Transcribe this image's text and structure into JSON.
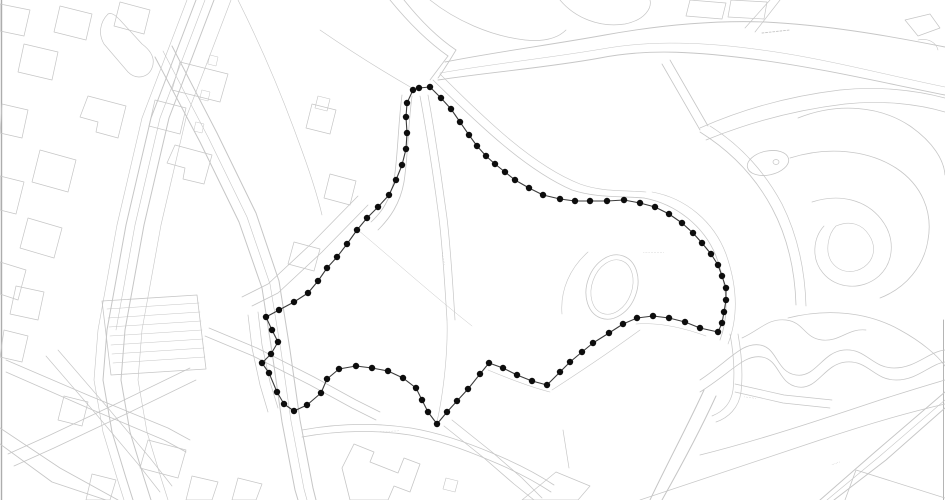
{
  "document": {
    "type": "site-location-plan",
    "canvas": {
      "width": 945,
      "height": 500
    }
  },
  "colors": {
    "background": "#ffffff",
    "map_line": "#c6c6c6",
    "map_line_dark": "#adadad",
    "sheet_edge": "#6f6f6f",
    "boundary_line": "#3c3c3c",
    "boundary_dot": "#0d0d0d",
    "micro_label": "#9a9a9a"
  },
  "boundary": {
    "name": "site-boundary",
    "closed": true,
    "line_width": 1.1,
    "dot_radius": 3.2,
    "points": [
      [
        413,
        90
      ],
      [
        419,
        88
      ],
      [
        430,
        87
      ],
      [
        441,
        98
      ],
      [
        451,
        109
      ],
      [
        460,
        122
      ],
      [
        469,
        135
      ],
      [
        477,
        146
      ],
      [
        486,
        156
      ],
      [
        495,
        164
      ],
      [
        505,
        172
      ],
      [
        515,
        180
      ],
      [
        529,
        188
      ],
      [
        543,
        195
      ],
      [
        560,
        199
      ],
      [
        575,
        201
      ],
      [
        590,
        201
      ],
      [
        607,
        201
      ],
      [
        624,
        200
      ],
      [
        640,
        203
      ],
      [
        655,
        207
      ],
      [
        669,
        214
      ],
      [
        682,
        223
      ],
      [
        693,
        233
      ],
      [
        702,
        243
      ],
      [
        711,
        254
      ],
      [
        718,
        265
      ],
      [
        722,
        276
      ],
      [
        726,
        288
      ],
      [
        726,
        300
      ],
      [
        724,
        312
      ],
      [
        722,
        323
      ],
      [
        718,
        332
      ],
      [
        700,
        328
      ],
      [
        685,
        322
      ],
      [
        669,
        318
      ],
      [
        653,
        316
      ],
      [
        637,
        318
      ],
      [
        623,
        324
      ],
      [
        609,
        333
      ],
      [
        593,
        343
      ],
      [
        582,
        352
      ],
      [
        570,
        362
      ],
      [
        560,
        372
      ],
      [
        547,
        385
      ],
      [
        532,
        381
      ],
      [
        517,
        375
      ],
      [
        503,
        368
      ],
      [
        489,
        363
      ],
      [
        480,
        374
      ],
      [
        468,
        389
      ],
      [
        457,
        401
      ],
      [
        447,
        412
      ],
      [
        437,
        424
      ],
      [
        428,
        412
      ],
      [
        422,
        400
      ],
      [
        416,
        388
      ],
      [
        403,
        378
      ],
      [
        388,
        371
      ],
      [
        372,
        368
      ],
      [
        356,
        366
      ],
      [
        339,
        369
      ],
      [
        327,
        379
      ],
      [
        321,
        393
      ],
      [
        307,
        405
      ],
      [
        294,
        411
      ],
      [
        284,
        404
      ],
      [
        277,
        392
      ],
      [
        269,
        373
      ],
      [
        262,
        363
      ],
      [
        271,
        354
      ],
      [
        278,
        342
      ],
      [
        272,
        330
      ],
      [
        266,
        317
      ],
      [
        279,
        310
      ],
      [
        294,
        302
      ],
      [
        308,
        293
      ],
      [
        318,
        281
      ],
      [
        327,
        268
      ],
      [
        337,
        257
      ],
      [
        347,
        244
      ],
      [
        357,
        230
      ],
      [
        367,
        218
      ],
      [
        378,
        207
      ],
      [
        389,
        195
      ],
      [
        396,
        180
      ],
      [
        402,
        165
      ],
      [
        406,
        149
      ],
      [
        407,
        133
      ],
      [
        406,
        117
      ],
      [
        407,
        103
      ]
    ]
  },
  "map": {
    "paths": [
      {
        "d": "M1.5,0 L1.5,500",
        "w": 1.4,
        "c": "dark"
      },
      {
        "d": "M943.5,320 L943.5,500",
        "w": 0.9,
        "c": "dark"
      },
      {
        "d": "M196,0 L151,118 126,225 107,330 103,380 112,432 126,478 133,500",
        "w": 1
      },
      {
        "d": "M214,0 L169,118 144,225 125,330 121,380 130,432 144,478 151,500",
        "w": 1
      },
      {
        "d": "M205,0 L160,118 135,225 116,330",
        "w": 0.6
      },
      {
        "d": "M187,0 L142,118 117,225 98,330 94,380 103,432 117,478 124,500",
        "w": 0.6
      },
      {
        "d": "M231,0 L186,118 161,225 142,330 138,380 147,432 161,478 168,500",
        "w": 0.6
      },
      {
        "d": "M210,55 L218,57 216,66 208,64 Z",
        "w": 0.5
      },
      {
        "d": "M202,90 L210,92 208,101 200,99 Z",
        "w": 0.5
      },
      {
        "d": "M196,122 L204,124 202,133 194,131 Z",
        "w": 0.5
      },
      {
        "d": "M108,14 C100,22 98,34 104,44 L128,72 C136,80 148,78 152,68 C156,58 150,50 142,44 L120,20 C116,16 112,12 108,14 Z",
        "w": 0.7
      },
      {
        "d": "M172,46 L217,133 256,213 279,281 290,350 300,420 313,488 316,500",
        "w": 1
      },
      {
        "d": "M155,57 L200,142 239,222 262,288 272,352 282,422 295,490 298,500",
        "w": 1
      },
      {
        "d": "M163,51 L208,137 247,217 270,284 281,351 291,421 304,489 307,500",
        "w": 0.6
      },
      {
        "d": "M258,312 L262,345 270,382 278,408",
        "w": 0.7
      },
      {
        "d": "M248,315 L252,348 260,385 268,412",
        "w": 0.7
      },
      {
        "d": "M205,336 L253,356 310,385 352,408 376,420",
        "w": 0.8
      },
      {
        "d": "M209,328 L257,348 314,377 356,400 380,412",
        "w": 0.8
      },
      {
        "d": "M302,437 C340,430 378,430 410,435 C438,440 463,449 489,460 C511,469 533,480 551,492",
        "w": 0.8
      },
      {
        "d": "M302,430 C340,423 378,423 411,428 C440,433 466,442 492,453 C514,462 536,473 554,485",
        "w": 0.8
      },
      {
        "d": "M342,468 L354,444 374,452 370,462 398,473 404,458 420,464 410,492 394,486 388,500 350,500 Z",
        "w": 0.8
      },
      {
        "d": "M446,478 L458,481 455,492 443,489 Z",
        "w": 0.6
      },
      {
        "d": "M452,420 L492,452 522,478 542,498",
        "w": 0.8
      },
      {
        "d": "M444,426 L484,458 514,484 534,500",
        "w": 0.8
      },
      {
        "d": "M563,430 L569,468",
        "w": 0.7
      },
      {
        "d": "M522,500 L556,472 590,486 578,500 Z",
        "w": 0.7
      },
      {
        "d": "M704,390 C688,425 668,462 650,500",
        "w": 1
      },
      {
        "d": "M716,396 C700,431 680,468 662,500",
        "w": 1
      },
      {
        "d": "M730,334 C734,355 735,372 733,390 C731,404 722,412 712,416",
        "w": 0.7
      },
      {
        "d": "M738,334 C742,356 743,374 741,392 C739,408 728,418 716,422",
        "w": 0.7
      },
      {
        "d": "M735,392 L783,403 830,408",
        "w": 0.7
      },
      {
        "d": "M735,384 L784,395 832,400",
        "w": 0.7
      },
      {
        "d": "M700,380 C730,360 742,342 760,345 C778,348 776,372 796,375 C816,378 822,352 844,350 C866,348 872,368 894,368 C916,368 928,352 945,350",
        "w": 0.8
      },
      {
        "d": "M700,392 C732,372 744,354 762,357 C780,360 778,384 798,387 C818,390 824,364 846,362 C868,360 874,380 896,380 C918,380 930,364 945,362",
        "w": 0.8
      },
      {
        "d": "M742,338 C760,330 768,318 786,320 C804,322 804,338 822,340 C840,342 848,328 866,330",
        "w": 0.7
      },
      {
        "d": "M700,455 C760,440 820,420 880,400 C905,392 928,385 945,380",
        "w": 0.8
      },
      {
        "d": "M640,500 C700,480 760,460 820,440 C865,425 910,412 945,404",
        "w": 0.7
      },
      {
        "d": "M945,392 L875,452 820,500",
        "w": 1
      },
      {
        "d": "M945,408 L886,460 834,500",
        "w": 1
      },
      {
        "d": "M945,400 L880,456 827,500",
        "w": 0.6
      },
      {
        "d": "M845,500 L856,470 945,498",
        "w": 0.8
      },
      {
        "d": "M798,118 C838,102 880,106 910,126 C933,142 944,160 945,175",
        "w": 0.8
      },
      {
        "d": "M790,158 C828,146 868,150 896,168 C922,185 933,212 928,240 C924,266 906,288 880,298",
        "w": 0.8
      },
      {
        "d": "M812,202 C840,193 866,200 881,219 C896,238 894,262 879,276 C862,291 836,289 823,273 C811,259 813,238 824,226",
        "w": 0.7
      },
      {
        "d": "M836,226 C850,220 862,224 869,235 C877,247 874,260 864,267 C852,275 838,272 831,261 C825,251 828,234 836,226",
        "w": 0.6
      },
      {
        "d": "M788,318 C828,308 868,312 900,330 C922,342 938,356 945,366",
        "w": 0.8
      },
      {
        "d": "M700,132 C732,152 756,178 772,208 C788,238 795,272 796,305",
        "w": 0.8
      },
      {
        "d": "M710,126 C742,146 766,174 782,204 C798,236 805,272 806,306",
        "w": 0.7
      },
      {
        "d": "M905,20 L930,14 940,28 918,36 Z",
        "w": 0.7
      },
      {
        "d": "M918,40 C928,38 936,42 938,50",
        "w": 0.6
      },
      {
        "d": "M438,80 C490,72 545,68 600,58 C650,48 700,52 760,60 C820,68 880,82 945,95",
        "w": 0.9
      },
      {
        "d": "M445,62 C495,52 550,45 605,35 C655,26 710,20 765,22 C825,25 885,35 945,47",
        "w": 0.9
      },
      {
        "d": "M440,73 C492,64 548,58 602,49 C652,40 705,42 762,50 C822,58 882,74 945,87",
        "w": 0.5
      },
      {
        "d": "M662,64 L700,130",
        "w": 0.8
      },
      {
        "d": "M670,60 L708,126",
        "w": 0.8
      },
      {
        "d": "M762,33 L790,30",
        "w": 0.9,
        "dash": "2,1.6"
      },
      {
        "d": "M700,128 C745,108 790,96 840,90 C878,86 915,90 945,98",
        "w": 0.7
      },
      {
        "d": "M706,140 C750,122 795,110 845,104 C882,100 918,104 945,112",
        "w": 0.7
      },
      {
        "d": "M690,0 L686,16 722,19 726,3 Z",
        "w": 0.7
      },
      {
        "d": "M731,0 L728,17 764,19 767,2 Z",
        "w": 0.7
      },
      {
        "d": "M770,0 L745,28",
        "w": 0.7
      },
      {
        "d": "M780,0 L755,32",
        "w": 0.7
      },
      {
        "d": "M560,0 C575,18 600,28 625,24 C645,20 652,8 650,0",
        "w": 0.7
      },
      {
        "d": "M430,0 C455,20 490,36 525,40 C545,42 558,38 566,30",
        "w": 0.7
      },
      {
        "d": "M390,0 C408,22 428,42 448,56",
        "w": 0.8
      },
      {
        "d": "M404,0 C420,20 438,38 456,50",
        "w": 0.8
      },
      {
        "d": "M448,56 C442,64 436,72 430,80",
        "w": 0.8
      },
      {
        "d": "M456,50 C450,60 444,70 438,78",
        "w": 0.8
      },
      {
        "d": "M402,95 C398,125 398,155 394,180 C390,200 382,212 371,222",
        "w": 0.8
      },
      {
        "d": "M412,96 C408,126 408,156 404,182 C400,204 390,218 378,230",
        "w": 0.8
      },
      {
        "d": "M368,205 L322,252 278,293 252,306",
        "w": 0.8
      },
      {
        "d": "M358,196 L312,243 268,284 242,297",
        "w": 0.8
      },
      {
        "d": "M320,30 C352,52 384,72 412,88",
        "w": 0.6
      },
      {
        "d": "M238,0 C258,40 280,90 298,140 C310,172 318,198 322,215",
        "w": 0.6
      },
      {
        "d": "M433,80 C480,126 526,170 572,190 C596,198 620,196 644,198",
        "w": 0.8
      },
      {
        "d": "M644,198 C676,204 704,226 716,256 C728,288 729,316 720,340",
        "w": 0.8
      },
      {
        "d": "M440,74 C488,122 534,166 580,184 C602,192 622,190 646,192",
        "w": 0.6
      },
      {
        "d": "M652,192 C686,198 714,222 726,254 C738,288 738,318 728,344",
        "w": 0.6
      },
      {
        "d": "M636,324 C660,322 684,328 706,336",
        "w": 0.6
      },
      {
        "d": "M488,370 C512,380 534,388 550,392",
        "w": 0.6
      },
      {
        "d": "M552,390 C580,372 610,352 640,330",
        "w": 0.6
      },
      {
        "d": "M420,96 C428,140 434,180 439,218 C443,252 445,288 447,320",
        "w": 0.7
      },
      {
        "d": "M428,95 C436,140 442,180 447,218 C451,252 453,288 455,320",
        "w": 0.7
      },
      {
        "d": "M447,320 C448,350 444,390 437,422",
        "w": 0.6
      },
      {
        "d": "M358,230 C396,262 434,296 472,326",
        "w": 0.5
      },
      {
        "d": "M588,252 C570,268 560,290 562,314",
        "w": 0.6
      },
      {
        "d": "M0,4 L30,10 24,36 0,31 Z",
        "w": 0.7
      },
      {
        "d": "M60,6 L92,14 86,40 54,32 Z",
        "w": 0.7
      },
      {
        "d": "M120,2 L150,10 144,34 114,26 Z",
        "w": 0.7
      },
      {
        "d": "M24,44 L58,52 52,80 18,72 Z",
        "w": 0.7
      },
      {
        "d": "M88,96 L126,106 118,138 96,132 98,122 80,117 Z",
        "w": 0.7
      },
      {
        "d": "M2,104 L28,110 22,138 0,133 Z",
        "w": 0.7
      },
      {
        "d": "M40,150 L76,160 68,192 32,182 Z",
        "w": 0.7
      },
      {
        "d": "M0,176 L24,182 16,214 0,210 Z",
        "w": 0.7
      },
      {
        "d": "M28,218 L62,228 54,258 20,248 Z",
        "w": 0.7
      },
      {
        "d": "M0,262 L26,270 18,300 0,294 Z",
        "w": 0.7
      },
      {
        "d": "M180,62 L228,74 220,102 172,90 Z",
        "w": 0.7
      },
      {
        "d": "M155,100 L186,108 180,134 149,126 Z",
        "w": 0.7
      },
      {
        "d": "M175,145 L212,155 204,184 183,179 185,168 167,163 Z",
        "w": 0.7
      },
      {
        "d": "M312,104 L336,110 330,134 306,128 Z",
        "w": 0.7
      },
      {
        "d": "M318,96 L330,99 327,111 315,108 Z",
        "w": 0.6
      },
      {
        "d": "M330,174 L356,181 350,205 324,198 Z",
        "w": 0.7
      },
      {
        "d": "M294,242 L320,249 314,271 288,264 Z",
        "w": 0.7
      },
      {
        "d": "M102,301 L197,295 206,369 111,375 Z",
        "w": 0.8
      },
      {
        "d": "M107,309 L199,303",
        "w": 0.5
      },
      {
        "d": "M108,318 L200,312",
        "w": 0.5
      },
      {
        "d": "M109,327 L201,321",
        "w": 0.5
      },
      {
        "d": "M110,336 L202,330",
        "w": 0.5
      },
      {
        "d": "M111,345 L203,339",
        "w": 0.5
      },
      {
        "d": "M112,354 L204,348",
        "w": 0.5
      },
      {
        "d": "M113,363 L205,357",
        "w": 0.5
      },
      {
        "d": "M6,360 L90,396 168,428 190,440",
        "w": 0.8
      },
      {
        "d": "M6,372 L88,408 164,440 186,452",
        "w": 0.8
      },
      {
        "d": "M190,368 L120,402 48,436 8,454",
        "w": 0.8
      },
      {
        "d": "M196,380 L126,414 54,448 14,466",
        "w": 0.8
      },
      {
        "d": "M58,350 L108,408 150,458 172,486",
        "w": 0.7
      },
      {
        "d": "M46,356 L96,414 138,464 160,492",
        "w": 0.7
      },
      {
        "d": "M16,286 L44,292 38,320 10,314 Z",
        "w": 0.7
      },
      {
        "d": "M4,330 L28,336 22,362 0,357 Z",
        "w": 0.7
      },
      {
        "d": "M64,396 L88,402 82,426 58,420 Z",
        "w": 0.7
      },
      {
        "d": "M148,440 L186,450 178,478 140,468 Z",
        "w": 0.7
      },
      {
        "d": "M92,474 L116,480 110,500 86,500 Z",
        "w": 0.7
      },
      {
        "d": "M192,476 L218,482 212,500 186,500 Z",
        "w": 0.7
      },
      {
        "d": "M238,478 L262,484 256,500 232,500 Z",
        "w": 0.7
      },
      {
        "d": "M0,428 L60,468 118,500",
        "w": 0.9
      },
      {
        "d": "M0,444 L52,482 106,500",
        "w": 0.9
      }
    ],
    "ellipses": [
      {
        "name": "site-pond-oval-outer",
        "cx": 612,
        "cy": 287,
        "rx": 25,
        "ry": 33,
        "rot": 20,
        "w": 0.8
      },
      {
        "name": "site-pond-oval-inner",
        "cx": 612,
        "cy": 287,
        "rx": 20,
        "ry": 28,
        "rot": 20,
        "w": 0.6
      },
      {
        "name": "park-pond-outer",
        "cx": 768,
        "cy": 163,
        "rx": 21,
        "ry": 12,
        "rot": -12,
        "w": 0.8
      },
      {
        "name": "park-pond-island",
        "cx": 776,
        "cy": 162,
        "rx": 3,
        "ry": 2.5,
        "rot": 0,
        "w": 0.7
      }
    ],
    "labels": [
      {
        "name": "micro-label-center",
        "x": 643,
        "y": 254,
        "rot": 0,
        "text": "··············"
      },
      {
        "name": "micro-label-path-vertical",
        "x": 441,
        "y": 252,
        "rot": 80,
        "text": "·········"
      },
      {
        "name": "micro-label-bottom-path",
        "x": 380,
        "y": 433,
        "rot": -3,
        "text": "·············"
      },
      {
        "name": "micro-label-right-path",
        "x": 744,
        "y": 398,
        "rot": 8,
        "text": "········"
      },
      {
        "name": "micro-label-bottom-right",
        "x": 832,
        "y": 466,
        "rot": -20,
        "text": "······"
      }
    ]
  }
}
